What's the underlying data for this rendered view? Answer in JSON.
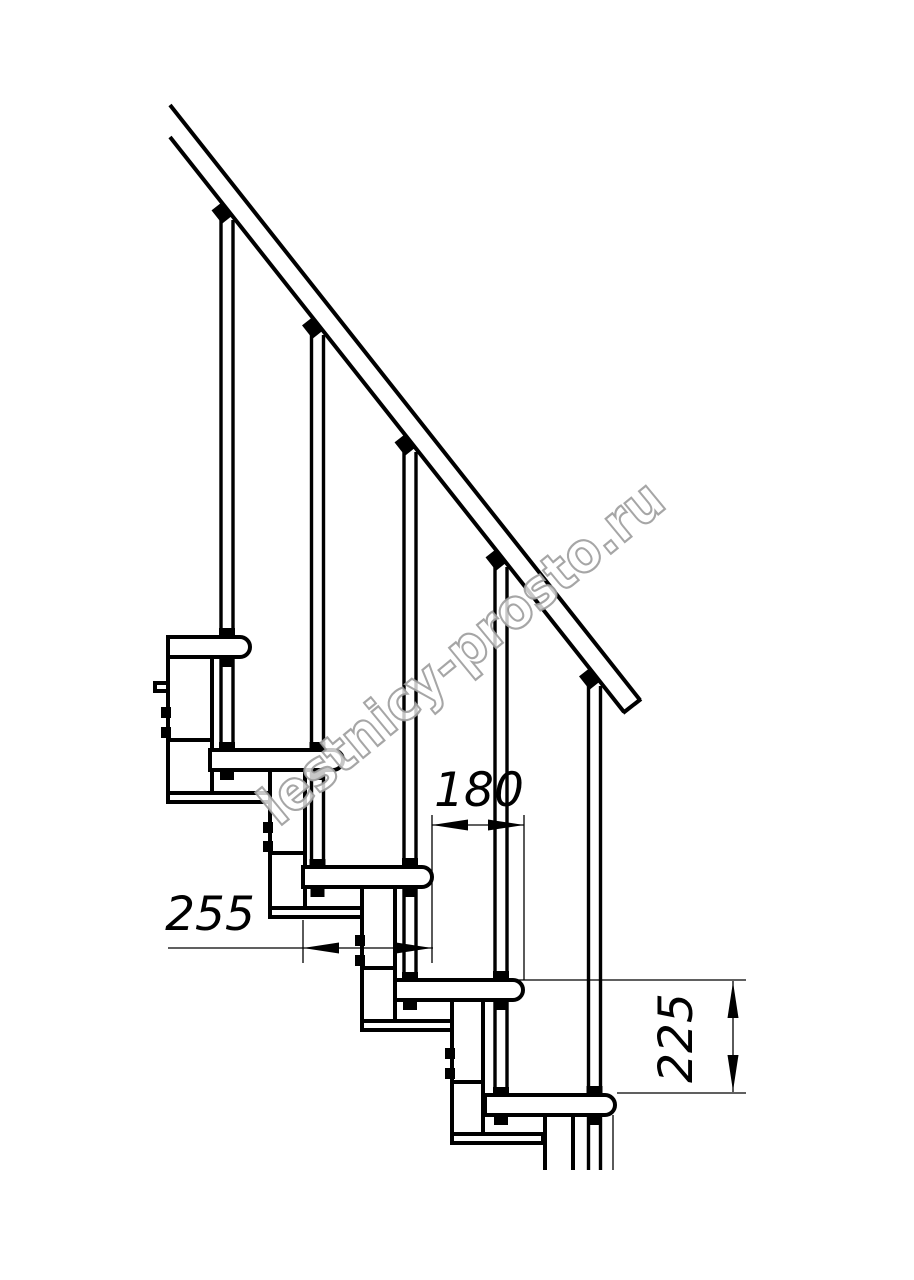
{
  "colors": {
    "background": "#ffffff",
    "line": "#000000",
    "watermark_stroke": "#9c9c9c",
    "watermark_fill": "#ffffff"
  },
  "watermark": {
    "text": "lestnicy-prosto.ru"
  },
  "dimensions": {
    "step_run": {
      "label": "180",
      "orientation": "horizontal"
    },
    "tread_depth": {
      "label": "255",
      "orientation": "horizontal"
    },
    "riser_height": {
      "label": "225",
      "orientation": "vertical"
    }
  },
  "structure": {
    "treads": 5,
    "balusters": 5,
    "support_plates": 5,
    "has_handrail": true
  }
}
